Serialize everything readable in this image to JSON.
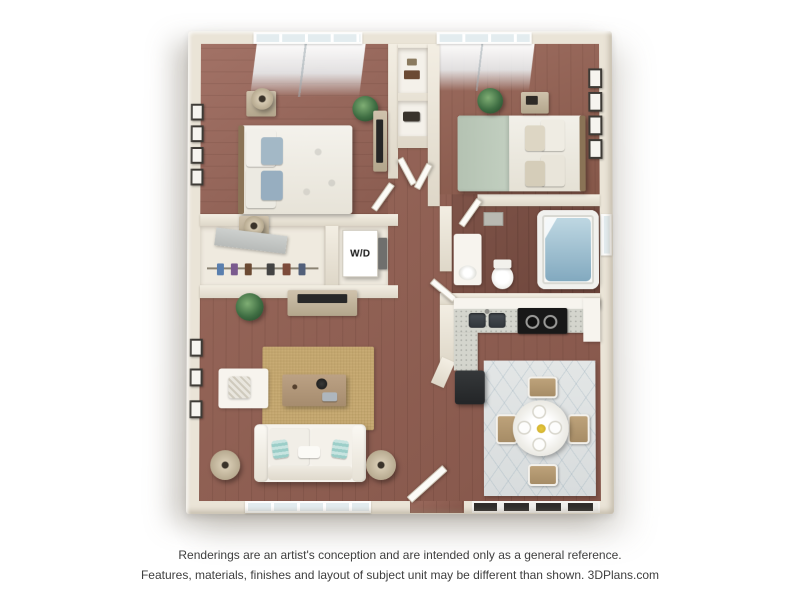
{
  "floor_plan": {
    "style": "3D top-down apartment rendering, 2 bedrooms / 1 bathroom",
    "labels": {
      "washer_dryer": "W/D"
    },
    "rooms": [
      "bedroom-1",
      "bedroom-2",
      "bathroom",
      "kitchen",
      "living-room",
      "dining-area",
      "hallway",
      "hall-closet",
      "wardrobe-closet",
      "laundry-closet"
    ],
    "furniture": [
      "bed",
      "nightstand",
      "table-lamp",
      "potted-plant",
      "picture-frame",
      "dresser-tv",
      "wardrobe-clothes",
      "washer-dryer",
      "vanity-sink",
      "toilet",
      "bathtub",
      "kitchen-sink",
      "stove",
      "refrigerator",
      "tv-console",
      "area-rug",
      "coffee-table",
      "armchair",
      "sofa",
      "floor-lamp",
      "dining-table",
      "dining-chair",
      "entry-door"
    ],
    "colors": {
      "background": "#ffffff",
      "walls": "#eae4d7",
      "wood_floor": "#93655a",
      "living_rug": "#c8ab74",
      "dining_rug": "#dde1e2",
      "pillow_teal": "#9ccec8",
      "pillow_blue": "#a3b8c6",
      "bedspread_sage": "#b9c6b6",
      "counter": "#d4d5cd",
      "appliance_black": "#181818",
      "tub_water": "#8fb4c8"
    }
  },
  "disclaimer": {
    "line1": "Renderings are an artist's conception and are intended only as a general reference.",
    "line2": "Features, materials, finishes and layout of subject unit may be different than shown. 3DPlans.com"
  }
}
